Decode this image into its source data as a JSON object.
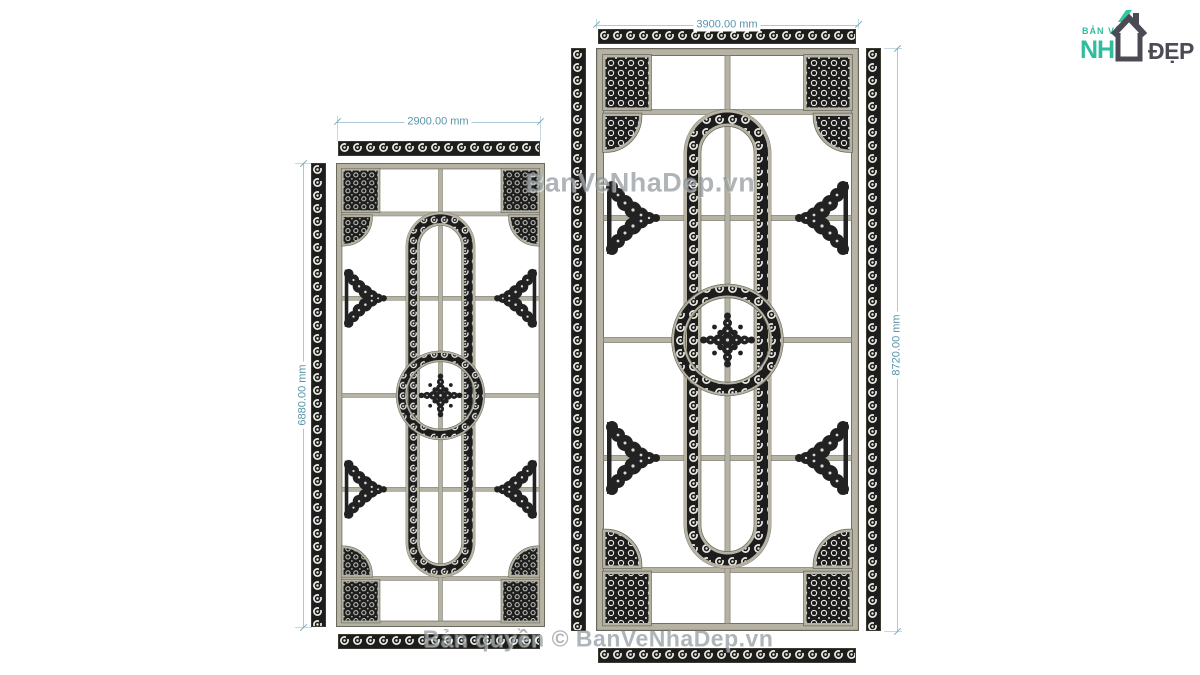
{
  "canvas": {
    "width": 1200,
    "height": 675,
    "background": "#ffffff"
  },
  "colors": {
    "frame": "#b6b3a4",
    "ornament": "#1d1d1d",
    "dim_line": "#abc9d6",
    "dim_text": "#5894a9",
    "watermark": "#6c777b",
    "logo_teal": "#2fbd9d",
    "logo_dark": "#4b4b55"
  },
  "logo": {
    "tagline": "BẢN VẼ",
    "brand_left": "NH",
    "brand_right": "ĐẸP",
    "icon": "house-icon"
  },
  "watermarks": {
    "middle": "BanVeNhaDep.vn",
    "bottom": "Bản quyền © BanVeNhaDep.vn"
  },
  "panels": {
    "left": {
      "width_label": "2900.00 mm",
      "height_label": "6880.00 mm"
    },
    "right": {
      "width_label": "3900.00 mm",
      "height_label": "8720.00 mm"
    }
  }
}
